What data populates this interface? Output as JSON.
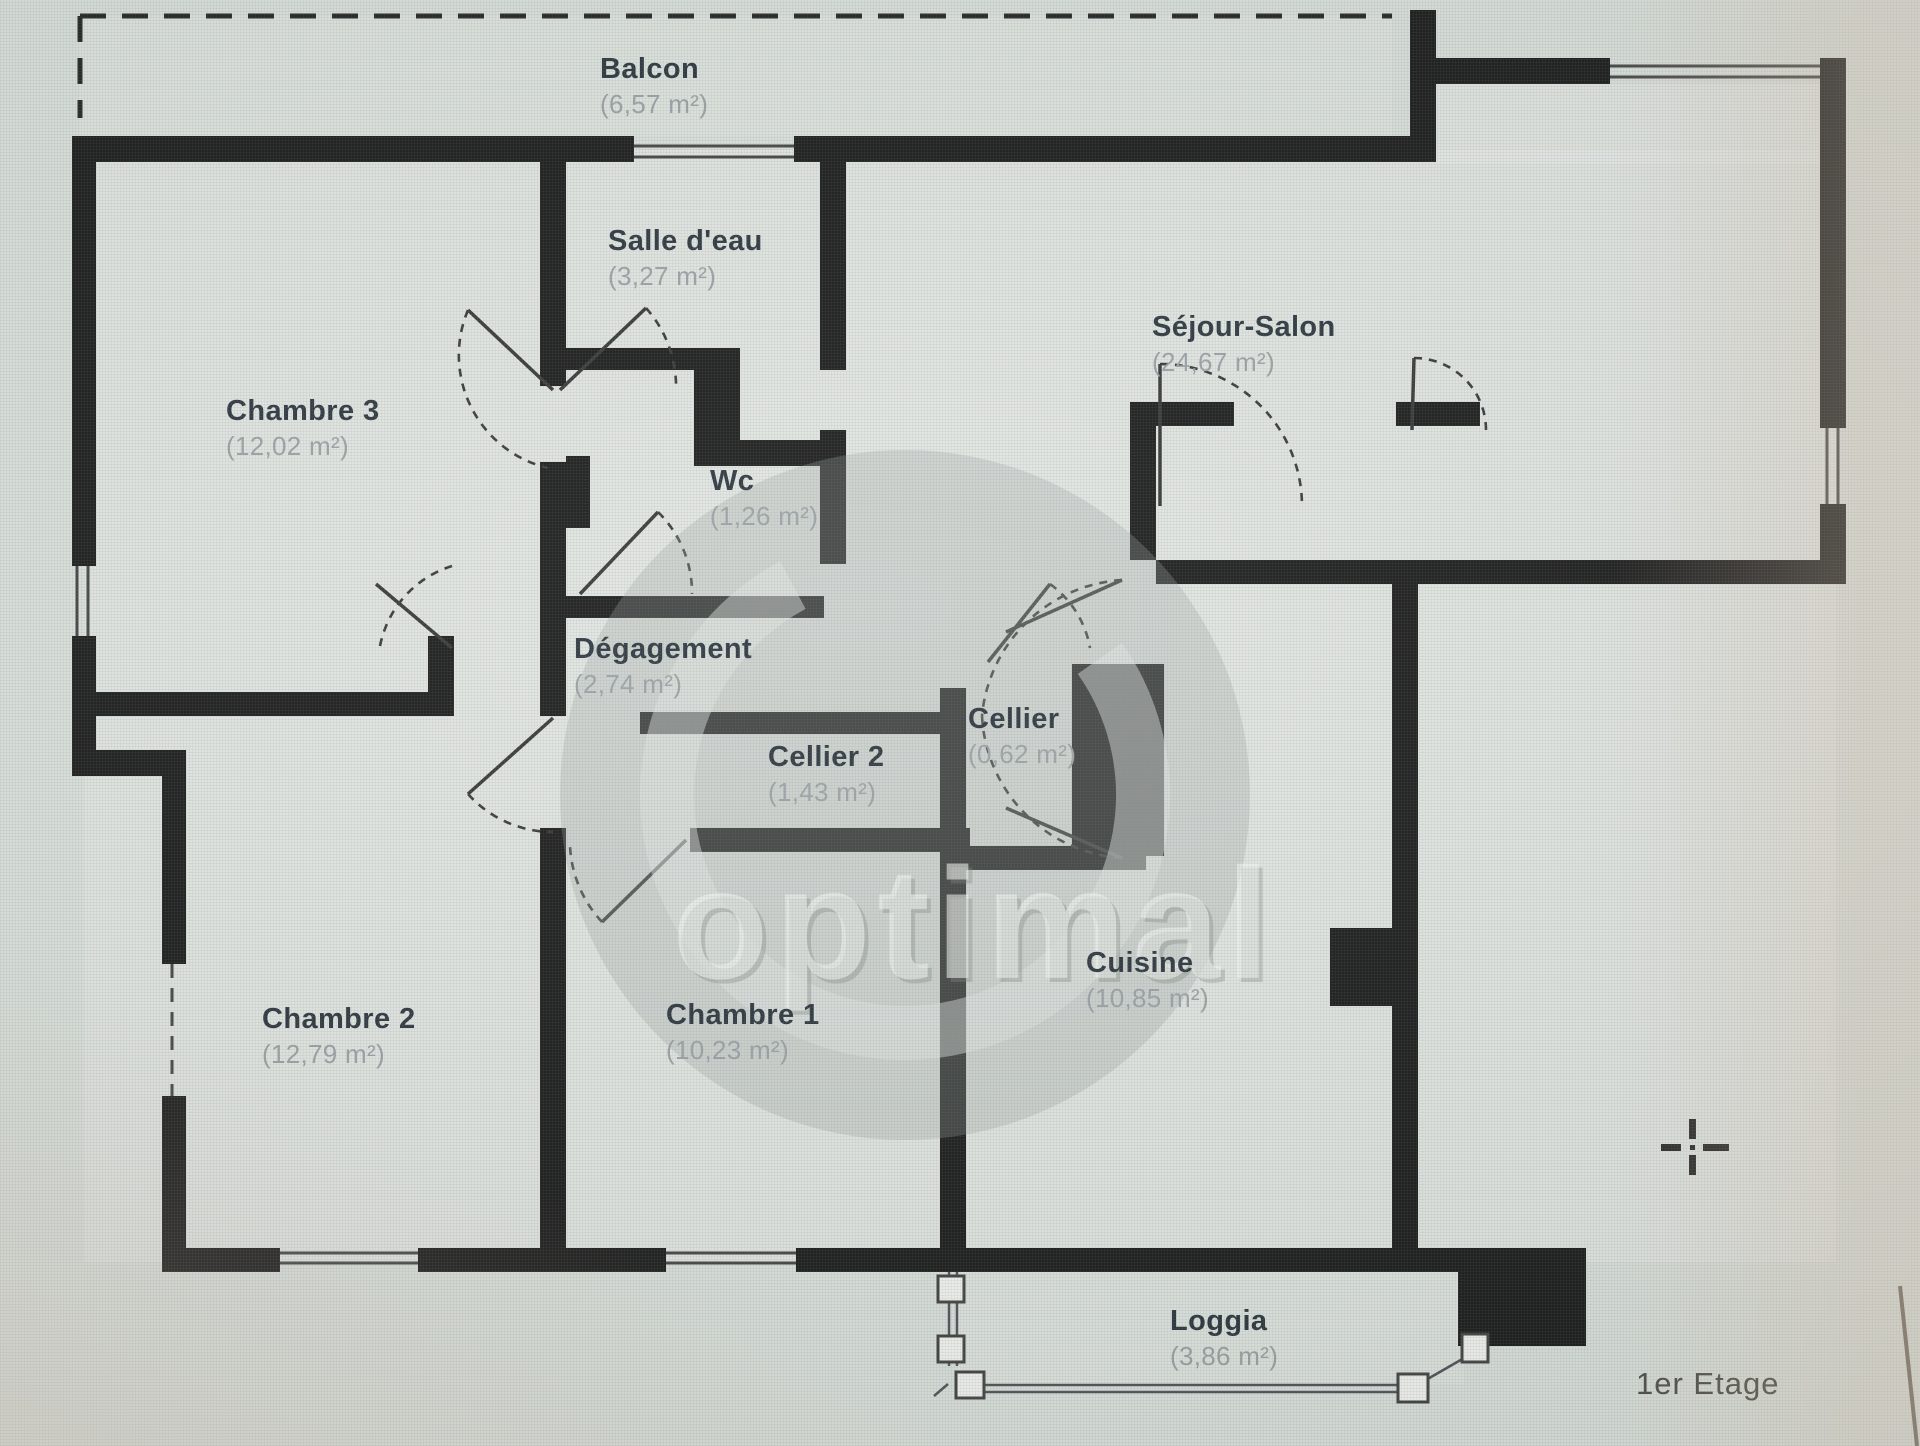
{
  "plan": {
    "floor_label": "1er Etage",
    "watermark_text": "optimal",
    "rooms": [
      {
        "name": "Balcon",
        "area": "(6,57 m²)"
      },
      {
        "name": "Salle d'eau",
        "area": "(3,27 m²)"
      },
      {
        "name": "Séjour-Salon",
        "area": "(24,67 m²)"
      },
      {
        "name": "Chambre 3",
        "area": "(12,02 m²)"
      },
      {
        "name": "Wc",
        "area": "(1,26 m²)"
      },
      {
        "name": "Dégagement",
        "area": "(2,74 m²)"
      },
      {
        "name": "Cellier",
        "area": "(0,62 m²)"
      },
      {
        "name": "Cellier 2",
        "area": "(1,43 m²)"
      },
      {
        "name": "Chambre 2",
        "area": "(12,79 m²)"
      },
      {
        "name": "Chambre 1",
        "area": "(10,23 m²)"
      },
      {
        "name": "Cuisine",
        "area": "(10,85 m²)"
      },
      {
        "name": "Loggia",
        "area": "(3,86 m²)"
      }
    ],
    "icons": {
      "crosshair": "+"
    },
    "colors": {
      "wall": "#121212",
      "room_name": "#242d36",
      "room_area": "#99a0a4",
      "background": "#dbe1dc",
      "floor_text": "#45443e"
    }
  }
}
